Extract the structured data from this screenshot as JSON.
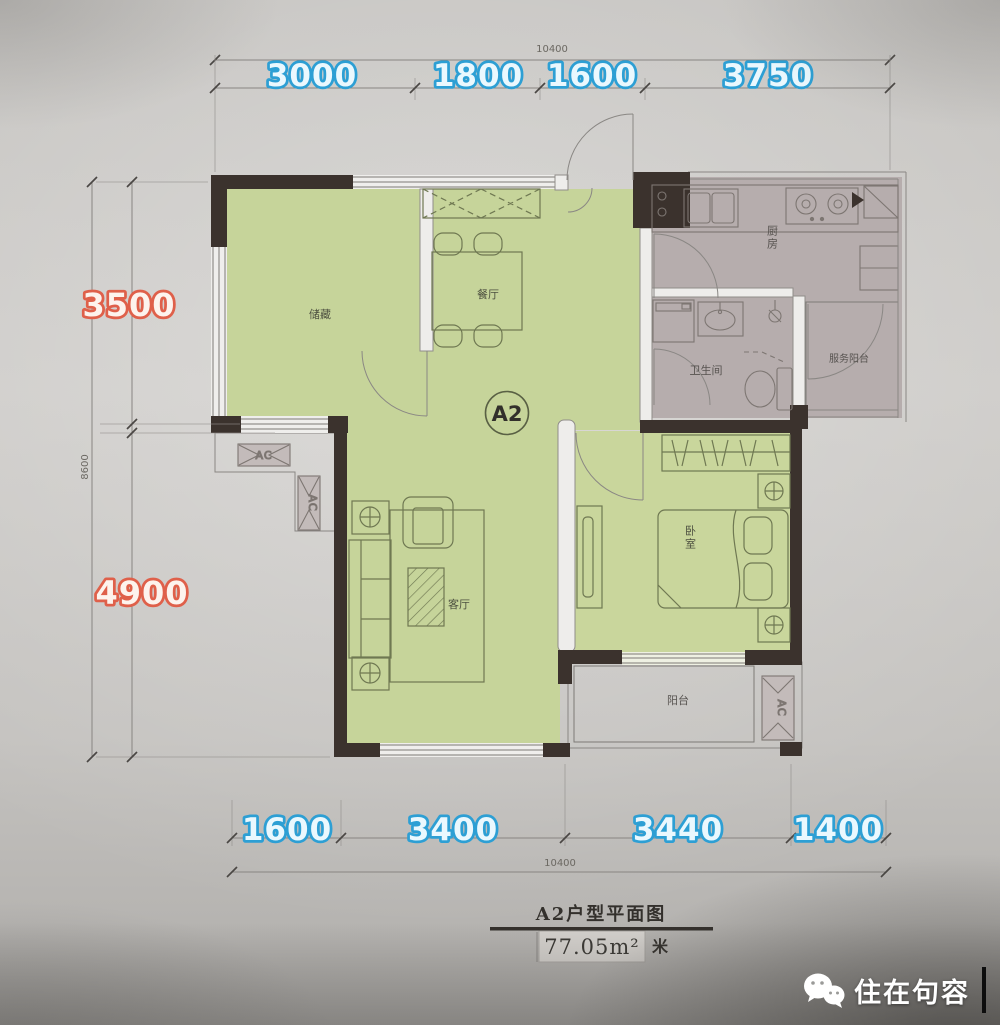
{
  "floorplan": {
    "unit_label": "A2",
    "dims": {
      "top_total": "10400",
      "top": [
        "3000",
        "1800",
        "1600",
        "3750"
      ],
      "left": [
        "3500",
        "4900"
      ],
      "left_total": "8600",
      "bottom": [
        "1600",
        "3400",
        "3440",
        "1400"
      ],
      "bottom_total": "10400"
    },
    "rooms": {
      "storage": "储藏",
      "dining": "餐厅",
      "kitchen": "厨房",
      "bathroom": "卫生间",
      "service_balcony": "服务阳台",
      "living_room": "客厅",
      "bedroom": "卧室",
      "balcony": "阳台"
    },
    "ac_label": "AC",
    "title_block": {
      "title": "A2户型平面图",
      "area": "77.05m²",
      "unit": "米"
    },
    "watermark": "住在句容",
    "colors": {
      "dim_blue": "#2d9fd4",
      "dim_orange": "#df604a",
      "room_green": "#c6d49a",
      "room_gray": "#b6adad",
      "wall": "#3b322d"
    }
  }
}
